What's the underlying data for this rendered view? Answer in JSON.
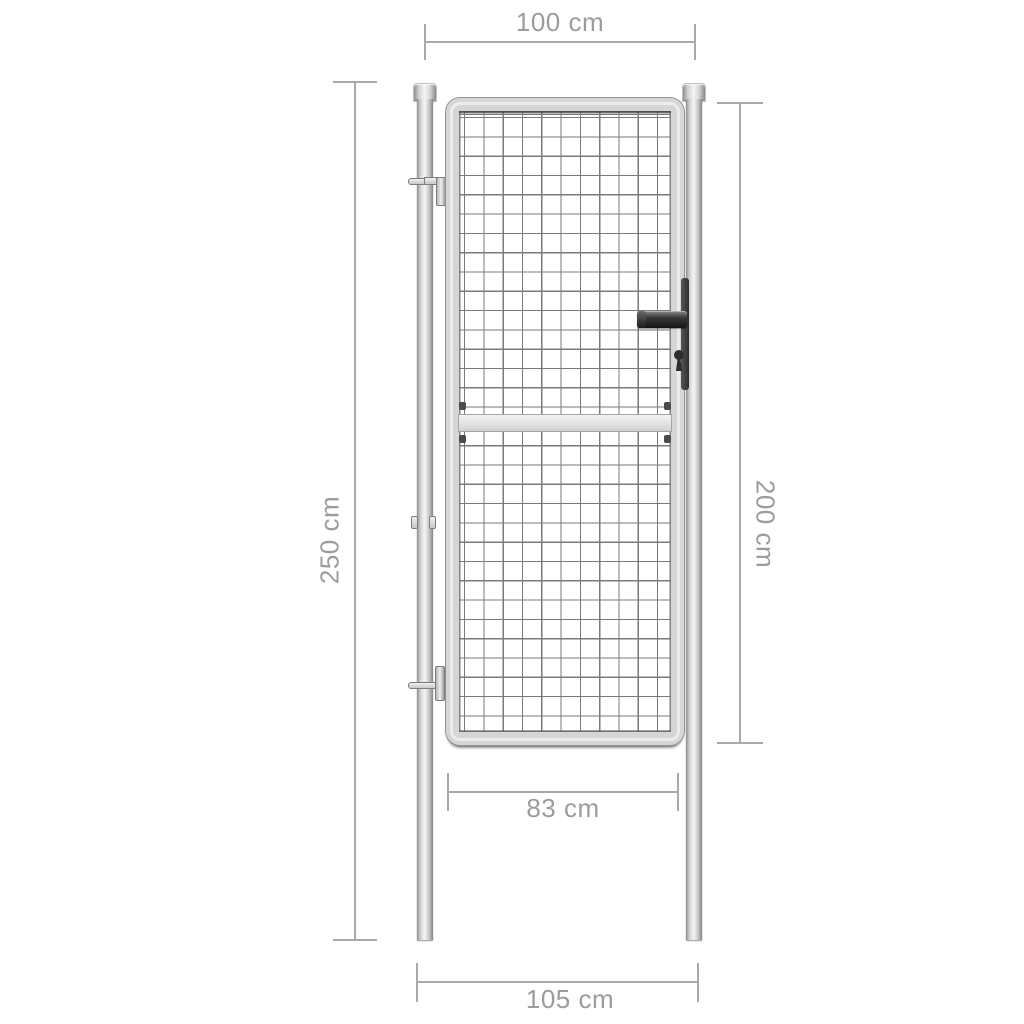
{
  "diagram": {
    "type": "product-dimension-diagram",
    "subject": "garden gate with mesh panel, two round posts, lever handle and lock",
    "colors": {
      "background": "#ffffff",
      "dimension_line": "#a9a9a9",
      "dimension_text": "#9c9c9c",
      "steel_light": "#f3f3f3",
      "steel_mid": "#d6d6d6",
      "steel_dark": "#8a8a8a",
      "mesh_line": "#7a7a7a",
      "handle_dark": "#2d2d2d"
    },
    "dimensions": {
      "top_width": {
        "label": "100 cm"
      },
      "left_height": {
        "label": "250 cm"
      },
      "right_height": {
        "label": "200 cm"
      },
      "inner_width": {
        "label": "83 cm"
      },
      "bottom_width": {
        "label": "105 cm"
      }
    }
  }
}
